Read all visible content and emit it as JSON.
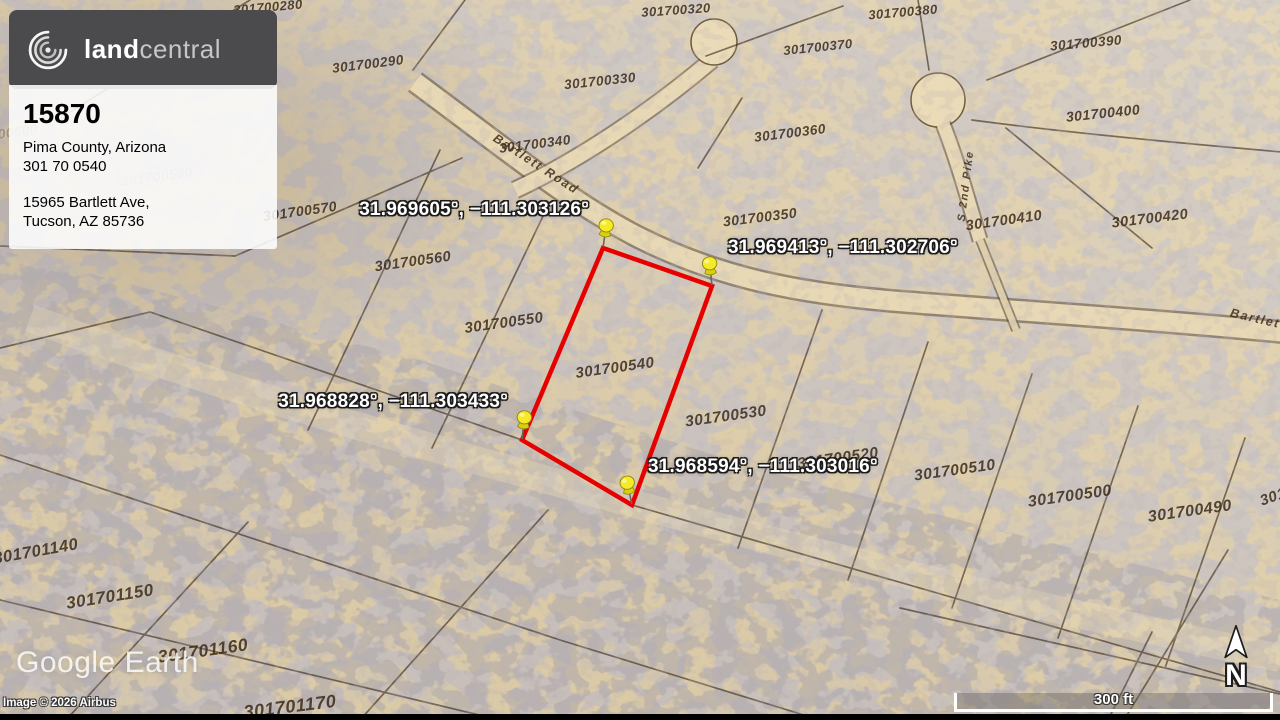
{
  "branding": {
    "logo_bold": "land",
    "logo_light": "central"
  },
  "listing": {
    "id": "15870",
    "location": "Pima County, Arizona",
    "apn": "301 70 0540",
    "address_line1": "15965 Bartlett Ave,",
    "address_line2": "Tucson, AZ 85736"
  },
  "map": {
    "provider": "Google Earth",
    "copyright": "Image © 2026 Airbus",
    "scale_label": "300 ft",
    "north_label": "N",
    "boundary_color": "#e60000",
    "pin_color": "#f4ea25",
    "boundary_points_px": [
      [
        603,
        248
      ],
      [
        712,
        286
      ],
      [
        632,
        505
      ],
      [
        522,
        440
      ]
    ],
    "pins": [
      {
        "coordinates": "31.969605°, −111.303126°",
        "x": 603,
        "y": 248,
        "side": "left",
        "tilt": 8
      },
      {
        "coordinates": "31.969413°, −111.302706°",
        "x": 712,
        "y": 286,
        "side": "right",
        "tilt": -6
      },
      {
        "coordinates": "31.968828°, −111.303433°",
        "x": 522,
        "y": 440,
        "side": "left",
        "tilt": 6
      },
      {
        "coordinates": "31.968594°, −111.303016°",
        "x": 632,
        "y": 505,
        "side": "right",
        "tilt": -12
      }
    ],
    "parcel_labels": [
      {
        "text": "301700280",
        "x": 268,
        "y": 7,
        "rot": -5,
        "size": 13
      },
      {
        "text": "301700320",
        "x": 676,
        "y": 10,
        "rot": -4,
        "size": 13
      },
      {
        "text": "301700380",
        "x": 903,
        "y": 12,
        "rot": -5,
        "size": 13
      },
      {
        "text": "301700370",
        "x": 818,
        "y": 47,
        "rot": -6,
        "size": 13
      },
      {
        "text": "301700390",
        "x": 1086,
        "y": 43,
        "rot": -5,
        "size": 13.5
      },
      {
        "text": "301700290",
        "x": 368,
        "y": 64,
        "rot": -7,
        "size": 13.5
      },
      {
        "text": "301700330",
        "x": 600,
        "y": 81,
        "rot": -6,
        "size": 13.5
      },
      {
        "text": "301700360",
        "x": 790,
        "y": 133,
        "rot": -7,
        "size": 13.5
      },
      {
        "text": "301700400",
        "x": 1103,
        "y": 113,
        "rot": -6,
        "size": 14
      },
      {
        "text": "301700340",
        "x": 535,
        "y": 144,
        "rot": -7,
        "size": 13.5
      },
      {
        "text": "301700350",
        "x": 760,
        "y": 217,
        "rot": -7,
        "size": 14
      },
      {
        "text": "301700410",
        "x": 1004,
        "y": 221,
        "rot": -8,
        "size": 14.5
      },
      {
        "text": "301700420",
        "x": 1150,
        "y": 219,
        "rot": -7,
        "size": 14.5
      },
      {
        "text": "301700600",
        "x": 2,
        "y": 134,
        "rot": -8,
        "size": 13.5,
        "faint": true
      },
      {
        "text": "301700580",
        "x": 157,
        "y": 177,
        "rot": -8,
        "size": 13.5,
        "faint": true
      },
      {
        "text": "301700570",
        "x": 300,
        "y": 211,
        "rot": -8,
        "size": 14
      },
      {
        "text": "301700560",
        "x": 413,
        "y": 262,
        "rot": -8,
        "size": 14.5
      },
      {
        "text": "301700550",
        "x": 504,
        "y": 323,
        "rot": -8,
        "size": 15
      },
      {
        "text": "301700540",
        "x": 615,
        "y": 368,
        "rot": -8,
        "size": 15
      },
      {
        "text": "301700530",
        "x": 726,
        "y": 417,
        "rot": -8,
        "size": 15.5
      },
      {
        "text": "301700520",
        "x": 838,
        "y": 459,
        "rot": -8,
        "size": 15.5
      },
      {
        "text": "301700510",
        "x": 955,
        "y": 471,
        "rot": -8,
        "size": 15.5
      },
      {
        "text": "301700500",
        "x": 1070,
        "y": 497,
        "rot": -8,
        "size": 16
      },
      {
        "text": "301700490",
        "x": 1190,
        "y": 512,
        "rot": -8,
        "size": 16
      },
      {
        "text": "301",
        "x": 1273,
        "y": 497,
        "rot": -20,
        "size": 15
      },
      {
        "text": "301701140",
        "x": 36,
        "y": 552,
        "rot": -10,
        "size": 16.5
      },
      {
        "text": "301701150",
        "x": 110,
        "y": 597,
        "rot": -9,
        "size": 17
      },
      {
        "text": "301701160",
        "x": 203,
        "y": 651,
        "rot": -8,
        "size": 17.5
      },
      {
        "text": "301701170",
        "x": 290,
        "y": 707,
        "rot": -7,
        "size": 18
      }
    ],
    "road_labels": [
      {
        "text": "Bartlett Road",
        "x": 536,
        "y": 164,
        "rot": 33,
        "size": 12.5
      },
      {
        "text": "Bartlett",
        "x": 1258,
        "y": 319,
        "rot": 13,
        "size": 12.5
      },
      {
        "text": "S 2nd Pike",
        "x": 966,
        "y": 186,
        "rot": -83,
        "size": 11
      }
    ]
  }
}
